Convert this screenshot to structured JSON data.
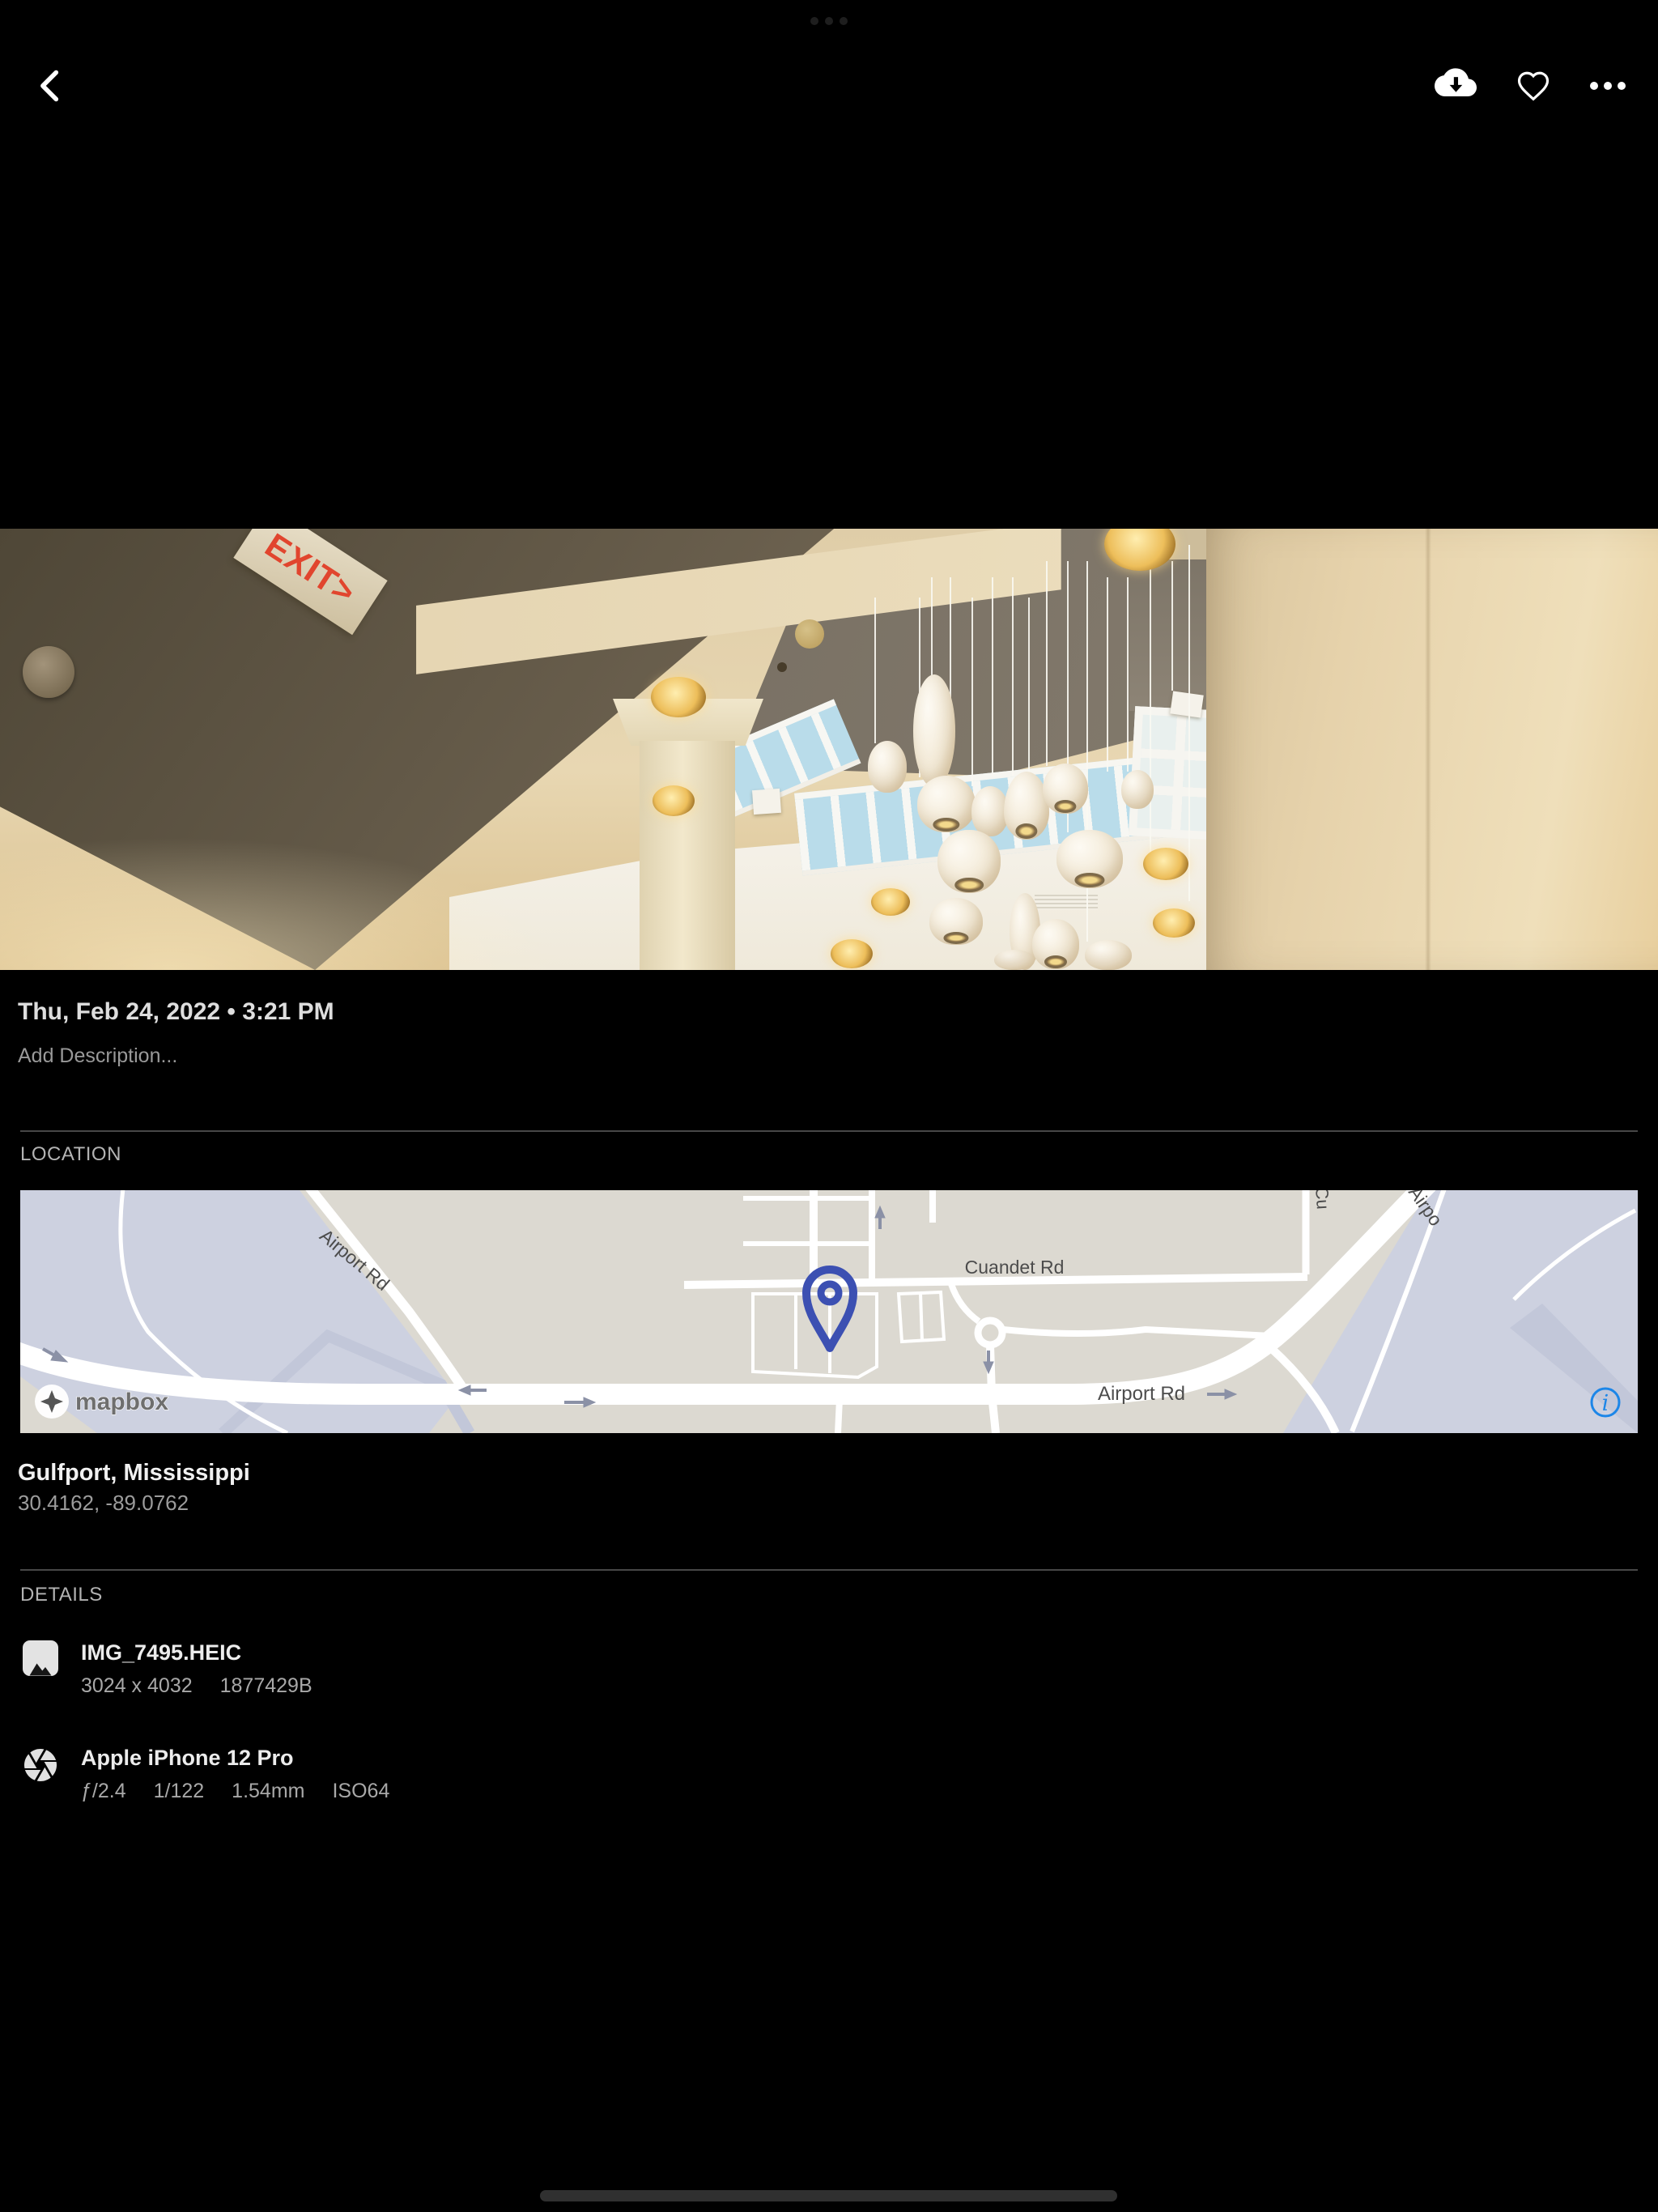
{
  "photo": {
    "exit_text": "EXIT>"
  },
  "meta": {
    "datetime": "Thu, Feb 24, 2022 • 3:21 PM",
    "description_placeholder": "Add Description..."
  },
  "location": {
    "label": "LOCATION",
    "place": "Gulfport, Mississippi",
    "coords": "30.4162, -89.0762",
    "map": {
      "attribution": "mapbox",
      "labels": {
        "cuandet": "Cuandet Rd",
        "airport_main": "Airport Rd",
        "airport_diag": "Airport Rd",
        "airport_clip": "Airpo",
        "cross_clip": "Cu"
      },
      "info_glyph": "i"
    }
  },
  "details": {
    "label": "DETAILS",
    "file": {
      "name": "IMG_7495.HEIC",
      "dimensions": "3024 x 4032",
      "size": "1877429B"
    },
    "camera": {
      "name": "Apple iPhone 12 Pro",
      "aperture": "ƒ/2.4",
      "shutter": "1/122",
      "focal_length": "1.54mm",
      "iso": "ISO64"
    }
  }
}
